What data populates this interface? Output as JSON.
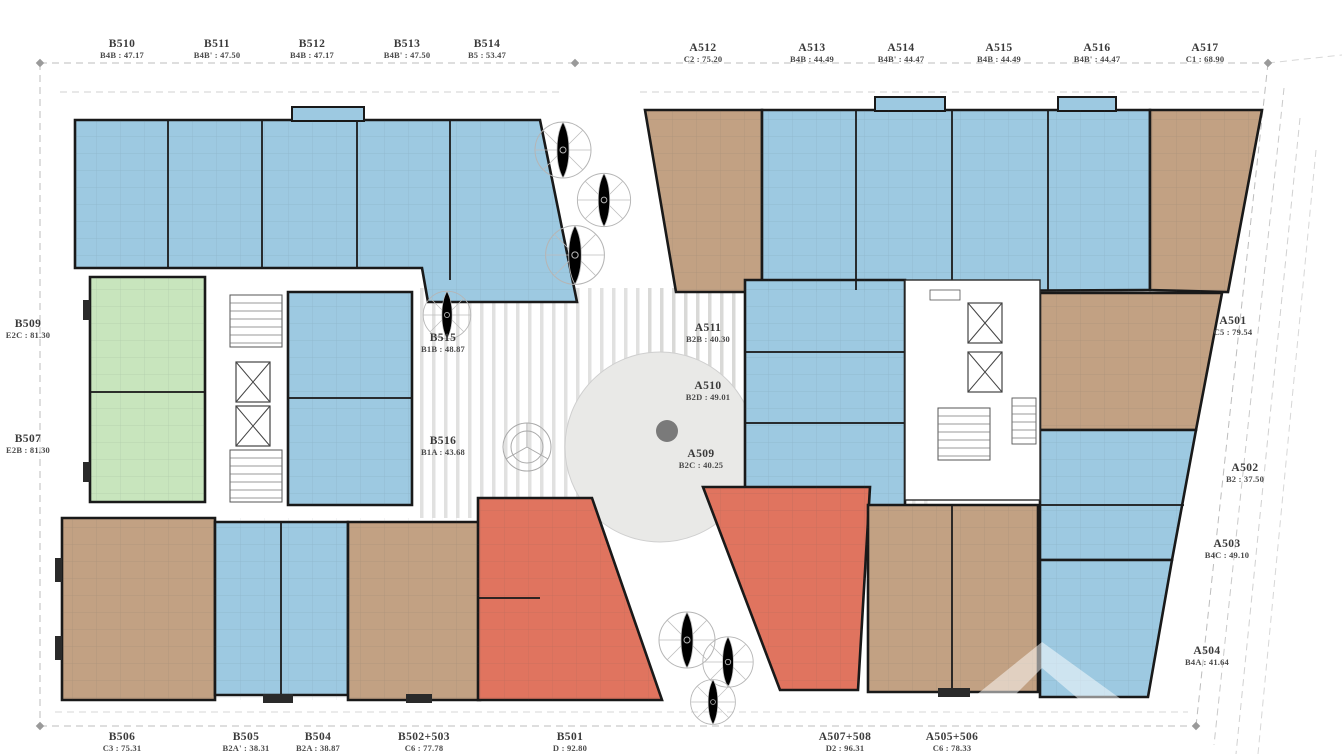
{
  "drawing": "apartment-floor-plan-level-5",
  "colors": {
    "unit_blue": "#9dc9e1",
    "unit_brown": "#c2a183",
    "unit_green": "#c8e5bd",
    "unit_red": "#e0745f",
    "wall": "#191919",
    "plaza_circle": "#e9e9e7",
    "plaza_dot": "#7a7a7a",
    "survey_line": "#bdbdbd",
    "label_text": "#3a3a3a"
  },
  "units": {
    "top": [
      {
        "id": "B510",
        "spec": "B4B : 47.17"
      },
      {
        "id": "B511",
        "spec": "B4B' : 47.50"
      },
      {
        "id": "B512",
        "spec": "B4B : 47.17"
      },
      {
        "id": "B513",
        "spec": "B4B' : 47.50"
      },
      {
        "id": "B514",
        "spec": "B5 : 53.47"
      }
    ],
    "top_right": [
      {
        "id": "A512",
        "spec": "C2 : 75.20"
      },
      {
        "id": "A513",
        "spec": "B4B : 44.49"
      },
      {
        "id": "A514",
        "spec": "B4B' : 44.47"
      },
      {
        "id": "A515",
        "spec": "B4B : 44.49"
      },
      {
        "id": "A516",
        "spec": "B4B' : 44.47"
      },
      {
        "id": "A517",
        "spec": "C1 : 68.90"
      }
    ],
    "left": [
      {
        "id": "B509",
        "spec": "E2C : 81.30"
      },
      {
        "id": "B507",
        "spec": "E2B : 81.30"
      }
    ],
    "right": [
      {
        "id": "A501",
        "spec": "C5 : 79.54"
      },
      {
        "id": "A502",
        "spec": "B2 : 37.50"
      },
      {
        "id": "A503",
        "spec": "B4C : 49.10"
      },
      {
        "id": "A504",
        "spec": "B4A : 41.64"
      }
    ],
    "bottom": [
      {
        "id": "B506",
        "spec": "C3 : 75.31"
      },
      {
        "id": "B505",
        "spec": "B2A' : 38.31"
      },
      {
        "id": "B504",
        "spec": "B2A : 38.87"
      },
      {
        "id": "B502+503",
        "spec": "C6 : 77.78"
      },
      {
        "id": "B501",
        "spec": "D : 92.80"
      },
      {
        "id": "A507+508",
        "spec": "D2 : 96.31"
      },
      {
        "id": "A505+506",
        "spec": "C6 : 78.33"
      }
    ],
    "inner": [
      {
        "id": "B515",
        "spec": "B1B : 48.87"
      },
      {
        "id": "B516",
        "spec": "B1A : 43.68"
      },
      {
        "id": "A511",
        "spec": "B2B : 40.30"
      },
      {
        "id": "A510",
        "spec": "B2D : 49.01"
      },
      {
        "id": "A509",
        "spec": "B2C : 40.25"
      }
    ]
  }
}
